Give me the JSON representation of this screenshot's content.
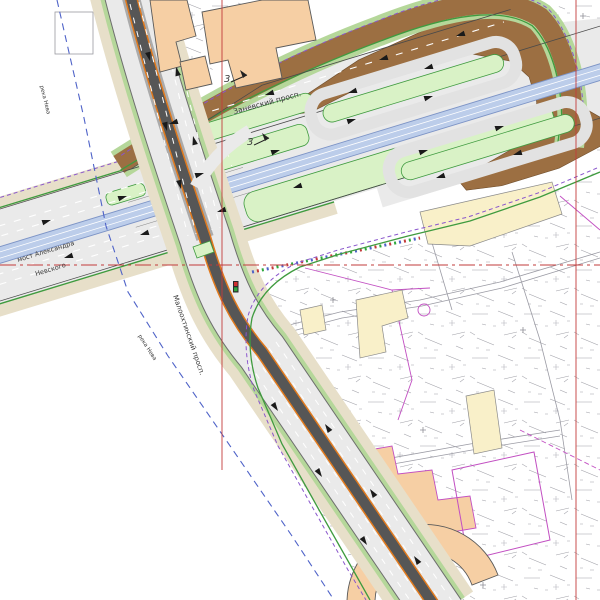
{
  "drawing": {
    "type": "road-interchange-engineering-plan",
    "area": "bridge approach interchange with U-turn loops over cadastral base map"
  },
  "labels": {
    "zanevsky": "Заневский просп.",
    "bridge_line1": "мост Александра",
    "bridge_line2": "Невского",
    "malookhtinsky": "Малоохтинский просп.",
    "neva_upper": "река Нева",
    "neva_lower": "река Нева"
  },
  "callouts": [
    {
      "label": "3"
    },
    {
      "label": "3"
    }
  ],
  "icons": [
    {
      "name": "traffic-signal-icon"
    },
    {
      "name": "lane-arrow"
    }
  ],
  "colors": {
    "road_light": "#eaeaea",
    "road_ring": "#e2e2e2",
    "asphalt_mid": "#ababab",
    "asphalt_dark": "#565656",
    "blue_median": "#bccdea",
    "blue_median_edge": "#7d94c6",
    "green_island": "#d9f2c6",
    "green_strip": "#b5d79a",
    "green_line": "#3f9b3f",
    "tan": "#e7dfc9",
    "brown": "#9c6f42",
    "bldg_peach": "#f6cfa4",
    "bldg_yellow": "#f9f0c9",
    "bldg_outline": "#5a5a5a",
    "magenta": "#c24fc2",
    "purple_dash": "#8a57cc",
    "blue_dash": "#4f63c8",
    "red_line": "#c23b3b",
    "orange_tram": "#e07a1e",
    "base_line": "#9b9ba4",
    "white_marking": "#ffffff",
    "signal_red": "#d03030",
    "signal_green": "#2fa83d"
  }
}
